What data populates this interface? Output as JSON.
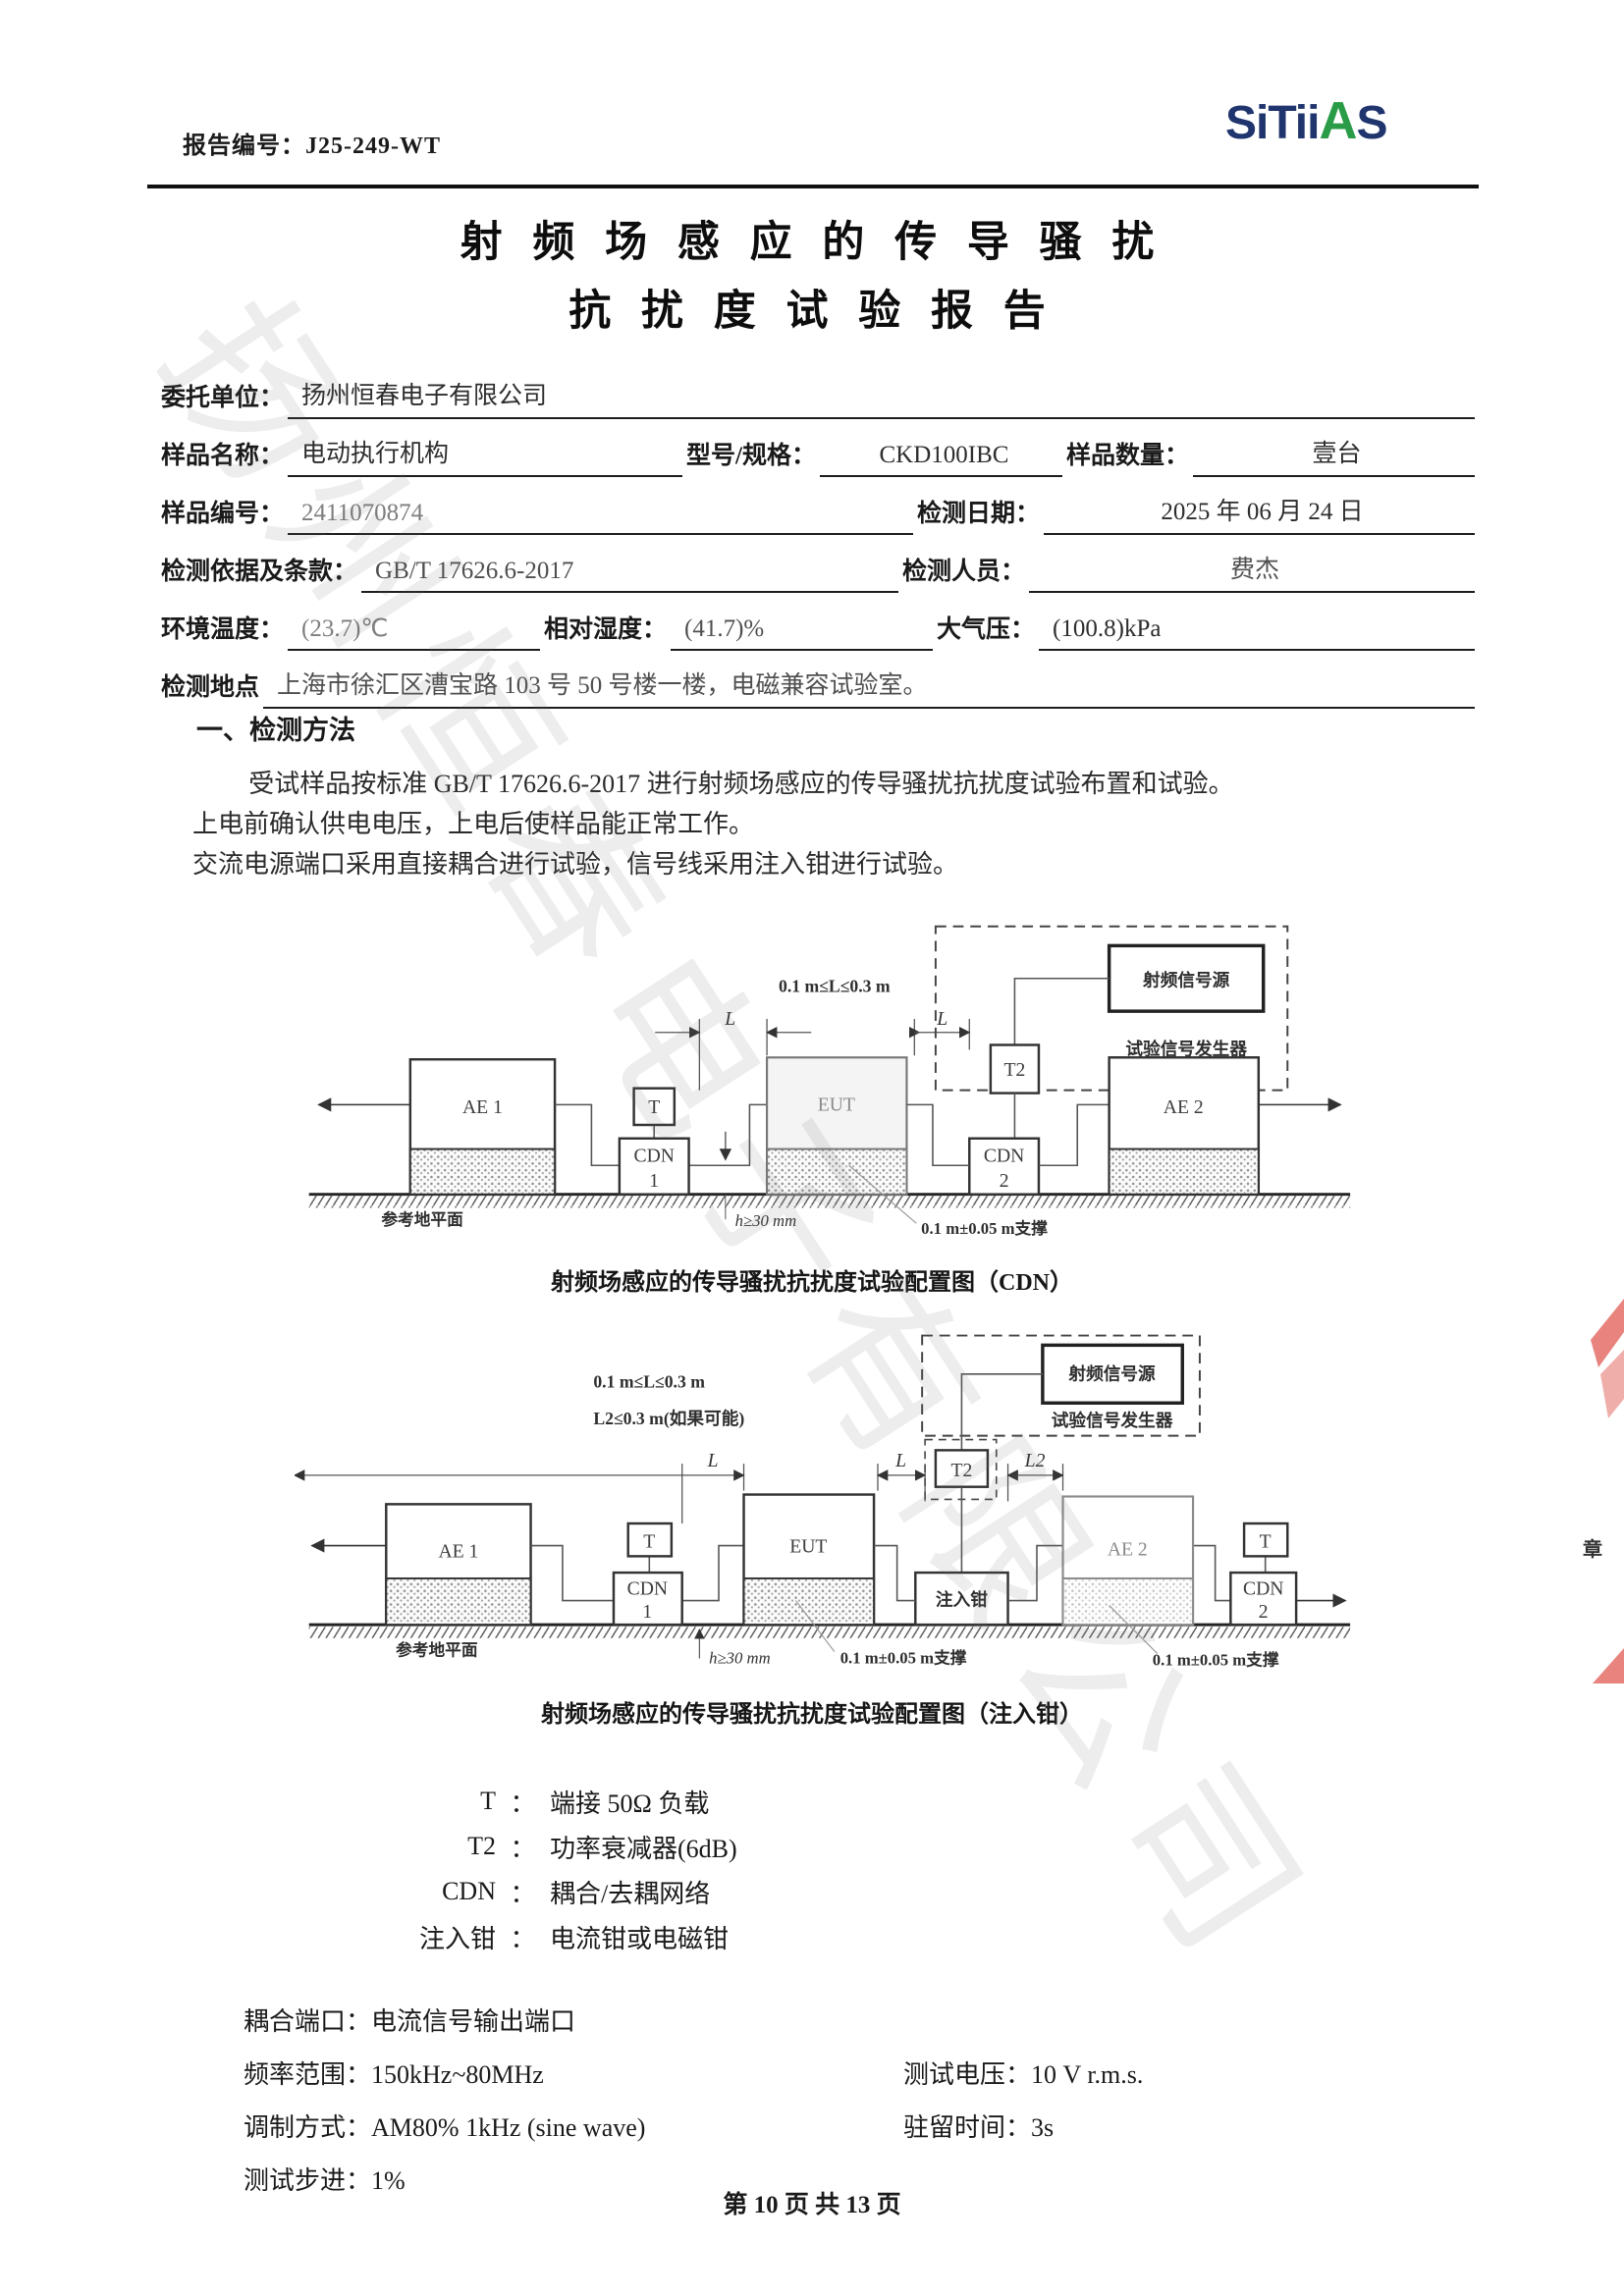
{
  "header": {
    "report_no_label": "报告编号：",
    "report_no": "J25-249-WT",
    "logo_part1": "SiTii",
    "logo_part2": "A",
    "logo_part3": "S"
  },
  "title": {
    "line1": "射 频 场 感 应 的 传 导 骚 扰",
    "line2": "抗 扰 度 试 验 报 告"
  },
  "form": {
    "client_label": "委托单位：",
    "client": "扬州恒春电子有限公司",
    "sample_name_label": "样品名称：",
    "sample_name": "电动执行机构",
    "model_label": "型号/规格：",
    "model": "CKD100IBC",
    "qty_label": "样品数量：",
    "qty": "壹台",
    "sample_no_label": "样品编号：",
    "sample_no": "2411070874",
    "test_date_label": "检测日期：",
    "test_date": "2025 年 06 月 24 日",
    "standard_label": "检测依据及条款：",
    "standard": "GB/T 17626.6-2017",
    "tester_label": "检测人员：",
    "tester": "费杰",
    "temp_label": "环境温度：",
    "temp": "(23.7)℃",
    "humidity_label": "相对湿度：",
    "humidity": "(41.7)%",
    "pressure_label": "大气压：",
    "pressure": "(100.8)kPa",
    "location_label": "检测地点",
    "location": "上海市徐汇区漕宝路 103 号 50 号楼一楼，电磁兼容试验室。"
  },
  "section1": {
    "heading": "一、检测方法",
    "para": [
      "受试样品按标准 GB/T 17626.6-2017 进行射频场感应的传导骚扰抗扰度试验布置和试验。",
      "上电前确认供电电压，上电后使样品能正常工作。",
      "交流电源端口采用直接耦合进行试验，信号线采用注入钳进行试验。"
    ]
  },
  "diagram1": {
    "dim_label": "0.1 m≤L≤0.3 m",
    "l_label": "L",
    "ae1": "AE 1",
    "t": "T",
    "cdn": "CDN",
    "one": "1",
    "eut": "EUT",
    "two": "2",
    "t2": "T2",
    "ae2": "AE 2",
    "rf_source": "射频信号源",
    "generator": "试验信号发生器",
    "ground": "参考地平面",
    "h_label": "h≥30 mm",
    "support": "0.1 m±0.05 m支撑",
    "caption": "射频场感应的传导骚扰抗扰度试验配置图（CDN）"
  },
  "diagram2": {
    "dim_label1": "0.1 m≤L≤0.3 m",
    "dim_label2": "L2≤0.3 m(如果可能)",
    "l_label": "L",
    "l2_label": "L2",
    "ae1": "AE 1",
    "t": "T",
    "cdn": "CDN",
    "one": "1",
    "eut": "EUT",
    "clamp": "注入钳",
    "t2": "T2",
    "ae2": "AE 2",
    "two": "2",
    "rf_source": "射频信号源",
    "generator": "试验信号发生器",
    "ground": "参考地平面",
    "h_label": "h≥30 mm",
    "support1": "0.1 m±0.05 m支撑",
    "support2": "0.1 m±0.05 m支撑",
    "caption": "射频场感应的传导骚扰抗扰度试验配置图（注入钳）"
  },
  "legend": {
    "colon": "：",
    "items": [
      {
        "term": "T",
        "desc": "端接 50Ω 负载"
      },
      {
        "term": "T2",
        "desc": "功率衰减器(6dB)"
      },
      {
        "term": "CDN",
        "desc": "耦合/去耦网络"
      },
      {
        "term": "注入钳",
        "desc": "电流钳或电磁钳"
      }
    ]
  },
  "params": {
    "coupling_label": "耦合端口：",
    "coupling": "电流信号输出端口",
    "freq_label": "频率范围：",
    "freq": "150kHz~80MHz",
    "voltage_label": "测试电压：",
    "voltage": "10 V r.m.s.",
    "modulation_label": "调制方式：",
    "modulation": "AM80% 1kHz (sine wave)",
    "dwell_label": "驻留时间：",
    "dwell": "3s",
    "step_label": "测试步进：",
    "step": "1%"
  },
  "footer": {
    "page_text": "第 10 页  共 13 页"
  },
  "watermark": "扬州恒春电子有限公司",
  "stamp": {
    "partial_char": "章"
  },
  "colors": {
    "logo_blue": "#20356e",
    "logo_green": "#2a9c48",
    "stamp_red": "#e8837e"
  }
}
